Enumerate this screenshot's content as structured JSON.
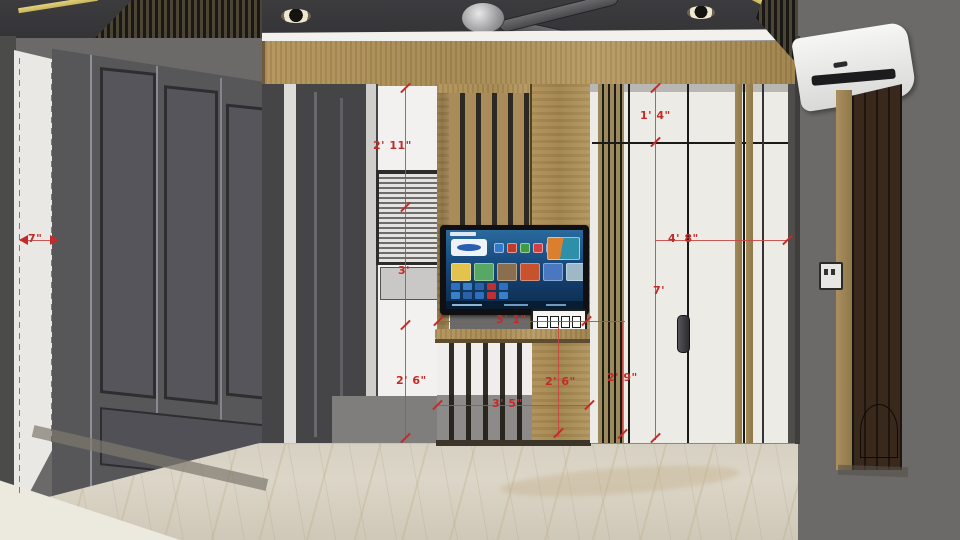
{
  "scene": {
    "type": "3d-interior-elevation-render",
    "subject": "living-room TV partition wall with dimension annotations"
  },
  "dimensions": {
    "left_gap_width": "7\"",
    "upper_partition_height": "2' 11\"",
    "window_height": "3'",
    "lower_left_height": "2' 6\"",
    "top_panel_height": "1' 4\"",
    "right_panel_width": "4' 8\"",
    "right_panel_height": "7'",
    "tv_unit_width": "3' 1\"",
    "partition_lower_height": "2' 6\"",
    "handle_panel_height": "2' 9\"",
    "partition_width": "3' 5\""
  },
  "colors": {
    "annotation_red": "#c22b28",
    "wood": "#ab8d58",
    "ceiling": "#3a393c",
    "gold_trim": "#d9c96f",
    "dark_wardrobe": "#57575a",
    "white_panel": "#edebe6",
    "right_wall": "#6b6a68",
    "marble_floor": "#d9d3c5"
  },
  "tv": {
    "screen_bg_top": "#2a6a9e",
    "screen_bg_bottom": "#0d2c4e",
    "hero_tile": "#eef3f8",
    "row1_icons": [
      "#3577c8",
      "#c03a2e",
      "#3f9b44",
      "#d34040",
      "#2b5fb0"
    ],
    "row2_tiles": [
      "#e3c24d",
      "#57a865",
      "#8a6f4e",
      "#c8522e",
      "#4a78c0",
      "#9fb8c8"
    ],
    "small_apps": [
      "#2e6fc0",
      "#3a80c8",
      "#2a62a8",
      "#c03030",
      "#2e6fc0",
      "#3a80c8",
      "#2a62a8",
      "#2e6fc0",
      "#c03030",
      "#3a80c8"
    ]
  }
}
